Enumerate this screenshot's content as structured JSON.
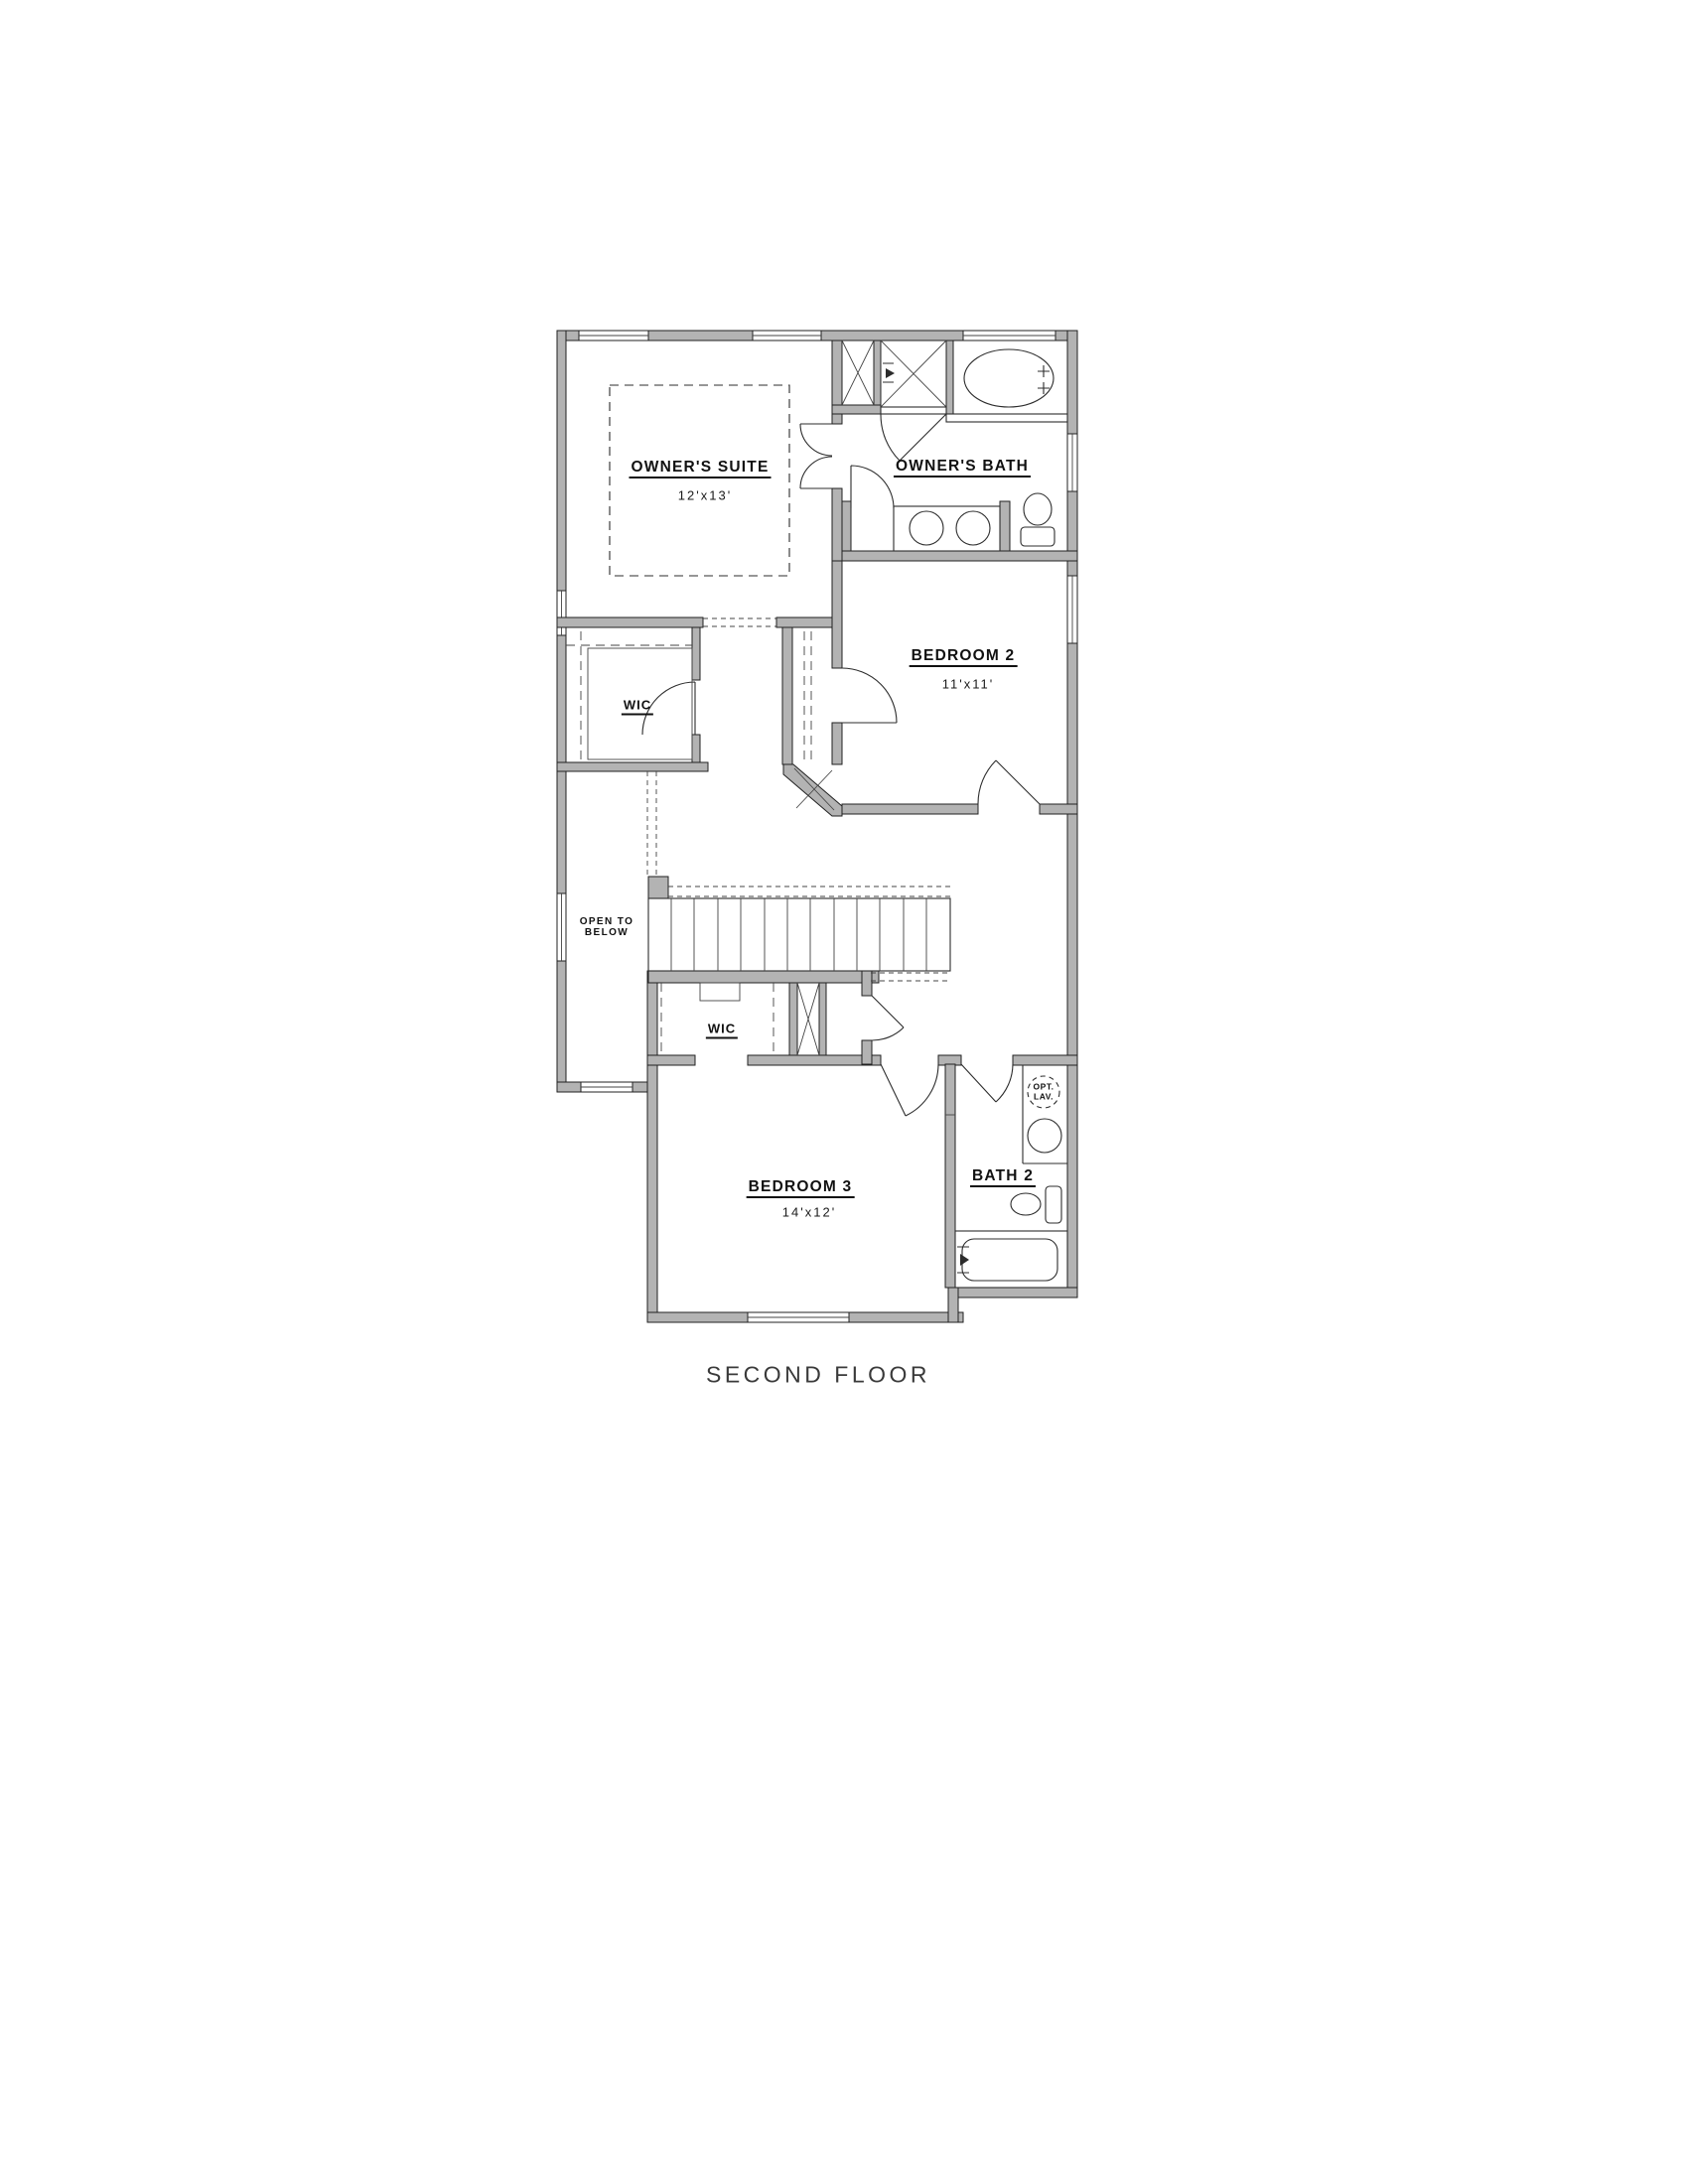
{
  "colors": {
    "wall_fill": "#b3b3b3",
    "line": "#2c2c2c",
    "text": "#111111",
    "background": "#ffffff"
  },
  "labels": {
    "owners_suite": "OWNER'S SUITE",
    "owners_suite_dim": "12'x13'",
    "owners_bath": "OWNER'S BATH",
    "bedroom2": "BEDROOM 2",
    "bedroom2_dim": "11'x11'",
    "wic_master": "WIC",
    "wic_bedroom3": "WIC",
    "open_to_below_l1": "OPEN TO",
    "open_to_below_l2": "BELOW",
    "bedroom3": "BEDROOM 3",
    "bedroom3_dim": "14'x12'",
    "bath2": "BATH 2",
    "opt_lav_l1": "OPT.",
    "opt_lav_l2": "LAV.",
    "caption": "SECOND FLOOR"
  }
}
